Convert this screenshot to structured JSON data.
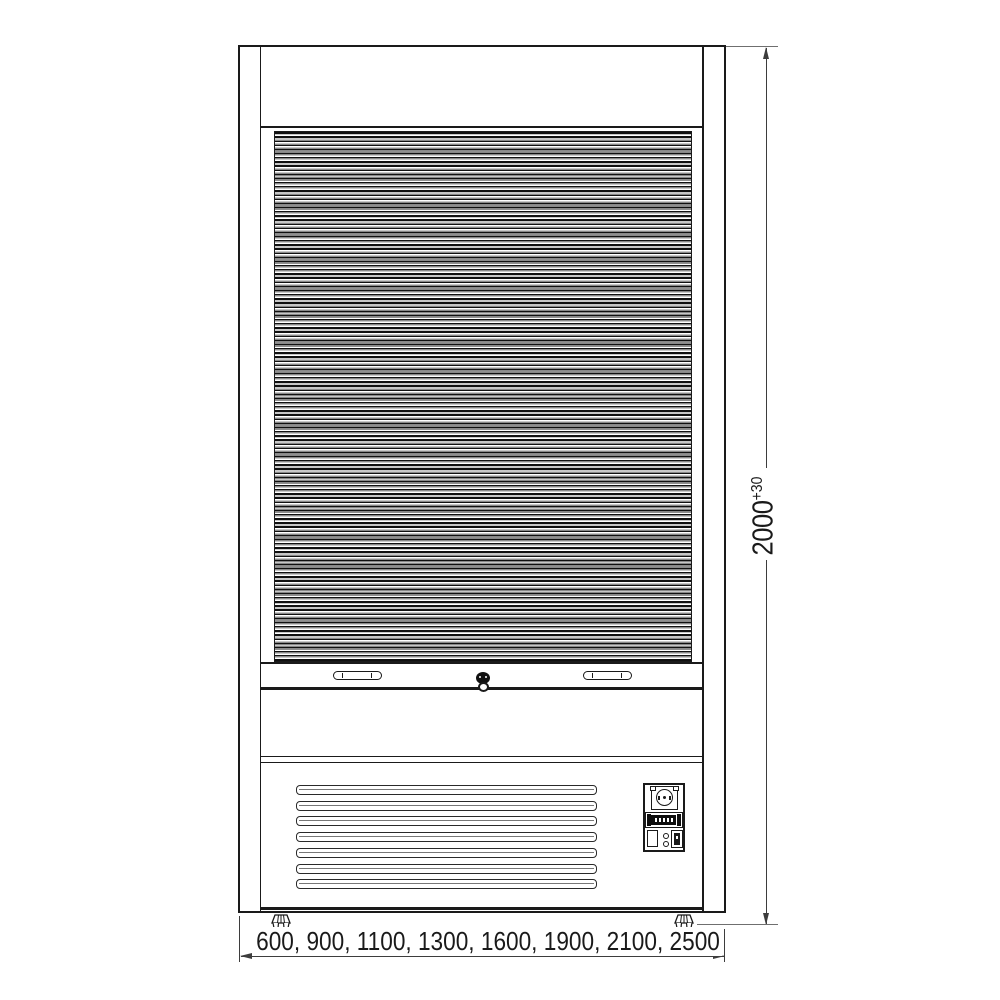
{
  "dimensions": {
    "height_label": "2000",
    "height_tolerance": "+30",
    "width_options_label": "600, 900, 1100, 1300, 1600, 1900, 2100, 2500"
  },
  "vent": {
    "louver_count": 7,
    "louver_top_start": 785,
    "louver_spacing": 15.7
  },
  "feet_count": 2,
  "icons": {
    "roller_shutter": "horizontal-slat-stripes",
    "handle": "recessed-pill-handle",
    "lock": "keyhole-circle",
    "power_socket": "schuko-socket-front",
    "controller_display": "segment-display",
    "power_switch": "rocker-switch",
    "leveling_foot": "adjustable-foot",
    "dimension_arrow": "cad-arrowhead"
  },
  "colors": {
    "line": "#1a1a1a",
    "dimension_line": "#3d3d3d",
    "extension_line": "#6f6f6f",
    "slat_dark": "#101010",
    "slat_mid": "#8f8f8f",
    "background": "#ffffff"
  }
}
